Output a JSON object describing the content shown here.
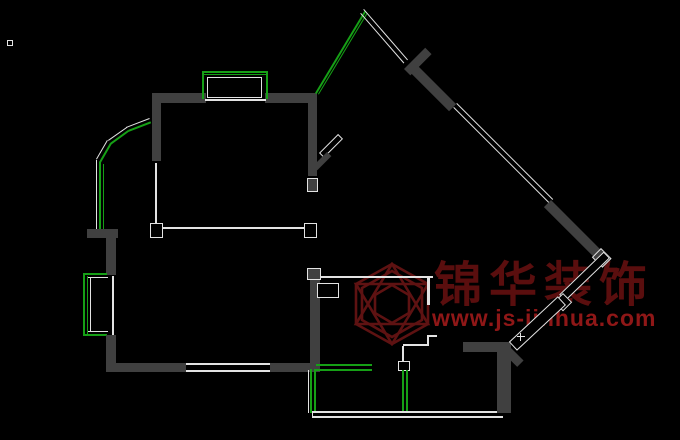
{
  "app": {
    "type": "cad-floorplan-screenshot",
    "background": "#000000"
  },
  "palette": {
    "wall": "#404040",
    "line": "#e3e3e3",
    "green": "#16a016"
  },
  "watermark": {
    "logo_icon": "hexagon-cube-logo",
    "logo_color": "#5e1212",
    "brand_text": "锦华装饰",
    "brand_color": "#5a0e0e",
    "url_text": "www.js-jinhua.com",
    "url_color": "#8f1717"
  },
  "floorplan": {
    "segments": [
      {
        "t": "cap",
        "x": 7,
        "y": 40,
        "w": 6,
        "h": 6
      },
      {
        "t": "wall",
        "x": 152,
        "y": 93,
        "w": 54,
        "h": 10
      },
      {
        "t": "wall",
        "x": 265,
        "y": 93,
        "w": 52,
        "h": 10
      },
      {
        "t": "line",
        "x": 205,
        "y": 99,
        "w": 61,
        "h": 2
      },
      {
        "t": "green",
        "x": 202,
        "y": 71,
        "w": 66,
        "h": 2
      },
      {
        "t": "green",
        "x": 202,
        "y": 74,
        "w": 66,
        "h": 1
      },
      {
        "t": "green",
        "x": 202,
        "y": 71,
        "w": 2,
        "h": 28
      },
      {
        "t": "green",
        "x": 266,
        "y": 71,
        "w": 2,
        "h": 28
      },
      {
        "t": "cap",
        "x": 207,
        "y": 77,
        "w": 55,
        "h": 21
      },
      {
        "t": "wall",
        "x": 152,
        "y": 93,
        "w": 9,
        "h": 68
      },
      {
        "t": "line",
        "x": 155,
        "y": 163,
        "w": 2,
        "h": 63
      },
      {
        "t": "line",
        "x": 152,
        "y": 227,
        "w": 165,
        "h": 2
      },
      {
        "t": "cap",
        "x": 150,
        "y": 223,
        "w": 13,
        "h": 15
      },
      {
        "t": "cap",
        "x": 304,
        "y": 223,
        "w": 13,
        "h": 15
      },
      {
        "t": "wall",
        "x": 308,
        "y": 93,
        "w": 9,
        "h": 83
      },
      {
        "t": "wbox",
        "x": 307,
        "y": 178,
        "w": 11,
        "h": 14
      },
      {
        "t": "cap",
        "x": 319,
        "y": 153,
        "w": 27,
        "h": 7,
        "r": -45
      },
      {
        "t": "wall",
        "x": 313,
        "y": 166,
        "w": 20,
        "h": 6,
        "r": -45
      },
      {
        "t": "line",
        "x": 126,
        "y": 127,
        "w": 25,
        "h": 1,
        "r": -21
      },
      {
        "t": "line",
        "x": 108,
        "y": 140,
        "w": 23,
        "h": 1,
        "r": -35
      },
      {
        "t": "line",
        "x": 96,
        "y": 159,
        "w": 22,
        "h": 1,
        "r": -60
      },
      {
        "t": "green",
        "x": 128,
        "y": 130,
        "w": 24,
        "h": 2,
        "r": -21
      },
      {
        "t": "green",
        "x": 110,
        "y": 143,
        "w": 22,
        "h": 2,
        "r": -36
      },
      {
        "t": "green",
        "x": 99,
        "y": 162,
        "w": 22,
        "h": 2,
        "r": -60
      },
      {
        "t": "line",
        "x": 96,
        "y": 160,
        "w": 1,
        "h": 77
      },
      {
        "t": "green",
        "x": 99,
        "y": 162,
        "w": 2,
        "h": 75
      },
      {
        "t": "green",
        "x": 103,
        "y": 164,
        "w": 1,
        "h": 73
      },
      {
        "t": "wall",
        "x": 87,
        "y": 229,
        "w": 31,
        "h": 9
      },
      {
        "t": "wall",
        "x": 106,
        "y": 238,
        "w": 10,
        "h": 37
      },
      {
        "t": "green",
        "x": 83,
        "y": 273,
        "w": 24,
        "h": 2
      },
      {
        "t": "green",
        "x": 83,
        "y": 334,
        "w": 24,
        "h": 2
      },
      {
        "t": "green",
        "x": 83,
        "y": 273,
        "w": 2,
        "h": 63
      },
      {
        "t": "green",
        "x": 87,
        "y": 276,
        "w": 1,
        "h": 58
      },
      {
        "t": "line",
        "x": 90,
        "y": 278,
        "w": 1,
        "h": 54
      },
      {
        "t": "line",
        "x": 88,
        "y": 277,
        "w": 20,
        "h": 1
      },
      {
        "t": "line",
        "x": 88,
        "y": 331,
        "w": 20,
        "h": 1
      },
      {
        "t": "line",
        "x": 112,
        "y": 276,
        "w": 2,
        "h": 59
      },
      {
        "t": "wall",
        "x": 106,
        "y": 335,
        "w": 10,
        "h": 37
      },
      {
        "t": "wall",
        "x": 106,
        "y": 363,
        "w": 80,
        "h": 9
      },
      {
        "t": "line",
        "x": 186,
        "y": 363,
        "w": 84,
        "h": 2
      },
      {
        "t": "line",
        "x": 186,
        "y": 370,
        "w": 84,
        "h": 2
      },
      {
        "t": "wall",
        "x": 270,
        "y": 363,
        "w": 50,
        "h": 9
      },
      {
        "t": "wall",
        "x": 310,
        "y": 268,
        "w": 10,
        "h": 97
      },
      {
        "t": "wbox",
        "x": 307,
        "y": 268,
        "w": 14,
        "h": 12
      },
      {
        "t": "cap",
        "x": 317,
        "y": 283,
        "w": 22,
        "h": 15
      },
      {
        "t": "line",
        "x": 320,
        "y": 276,
        "w": 113,
        "h": 2
      },
      {
        "t": "line",
        "x": 427,
        "y": 278,
        "w": 3,
        "h": 27
      },
      {
        "t": "line",
        "x": 427,
        "y": 335,
        "w": 10,
        "h": 2
      },
      {
        "t": "line",
        "x": 427,
        "y": 335,
        "w": 2,
        "h": 11
      },
      {
        "t": "line",
        "x": 403,
        "y": 344,
        "w": 26,
        "h": 2
      },
      {
        "t": "line",
        "x": 402,
        "y": 346,
        "w": 2,
        "h": 18
      },
      {
        "t": "cap",
        "x": 398,
        "y": 361,
        "w": 12,
        "h": 10
      },
      {
        "t": "green",
        "x": 316,
        "y": 364,
        "w": 56,
        "h": 2
      },
      {
        "t": "green",
        "x": 316,
        "y": 369,
        "w": 56,
        "h": 2
      },
      {
        "t": "green",
        "x": 402,
        "y": 370,
        "w": 2,
        "h": 43
      },
      {
        "t": "green",
        "x": 406,
        "y": 370,
        "w": 2,
        "h": 43
      },
      {
        "t": "line",
        "x": 308,
        "y": 370,
        "w": 1,
        "h": 43
      },
      {
        "t": "green",
        "x": 310,
        "y": 369,
        "w": 2,
        "h": 44
      },
      {
        "t": "green",
        "x": 314,
        "y": 369,
        "w": 2,
        "h": 44
      },
      {
        "t": "line",
        "x": 312,
        "y": 411,
        "w": 191,
        "h": 2
      },
      {
        "t": "line",
        "x": 312,
        "y": 416,
        "w": 191,
        "h": 2
      },
      {
        "t": "line",
        "x": 312,
        "y": 411,
        "w": 1,
        "h": 7
      },
      {
        "t": "wall",
        "x": 463,
        "y": 342,
        "w": 42,
        "h": 10
      },
      {
        "t": "wall",
        "x": 497,
        "y": 342,
        "w": 14,
        "h": 71
      },
      {
        "t": "wall",
        "x": 508,
        "y": 345,
        "w": 22,
        "h": 9,
        "r": 45
      },
      {
        "t": "green",
        "x": 315,
        "y": 93,
        "w": 96,
        "h": 2,
        "r": -59
      },
      {
        "t": "green",
        "x": 318,
        "y": 94,
        "w": 94,
        "h": 1,
        "r": -59
      },
      {
        "t": "line",
        "x": 364,
        "y": 9,
        "w": 67,
        "h": 1,
        "r": 49
      },
      {
        "t": "line",
        "x": 361,
        "y": 13,
        "w": 66,
        "h": 1,
        "r": 49
      },
      {
        "t": "wall",
        "x": 404,
        "y": 69,
        "w": 30,
        "h": 9,
        "r": -45
      },
      {
        "t": "wall",
        "x": 413,
        "y": 61,
        "w": 61,
        "h": 10,
        "r": 45
      },
      {
        "t": "line",
        "x": 457,
        "y": 103,
        "w": 136,
        "h": 1,
        "r": 45
      },
      {
        "t": "line",
        "x": 454,
        "y": 107,
        "w": 136,
        "h": 1,
        "r": 45
      },
      {
        "t": "wall",
        "x": 551,
        "y": 200,
        "w": 74,
        "h": 10,
        "r": 45
      },
      {
        "t": "wbox",
        "x": 601,
        "y": 248,
        "w": 15,
        "h": 13,
        "r": 45
      },
      {
        "t": "cap",
        "x": 610,
        "y": 258,
        "w": 62,
        "h": 9,
        "r": 136
      },
      {
        "t": "cap",
        "x": 563,
        "y": 293,
        "w": 13,
        "h": 13,
        "r": 45
      },
      {
        "t": "cap",
        "x": 566,
        "y": 305,
        "w": 67,
        "h": 12,
        "r": 137
      },
      {
        "t": "line",
        "x": 517,
        "y": 336,
        "w": 8,
        "h": 1
      },
      {
        "t": "line",
        "x": 520,
        "y": 333,
        "w": 1,
        "h": 8
      }
    ]
  }
}
